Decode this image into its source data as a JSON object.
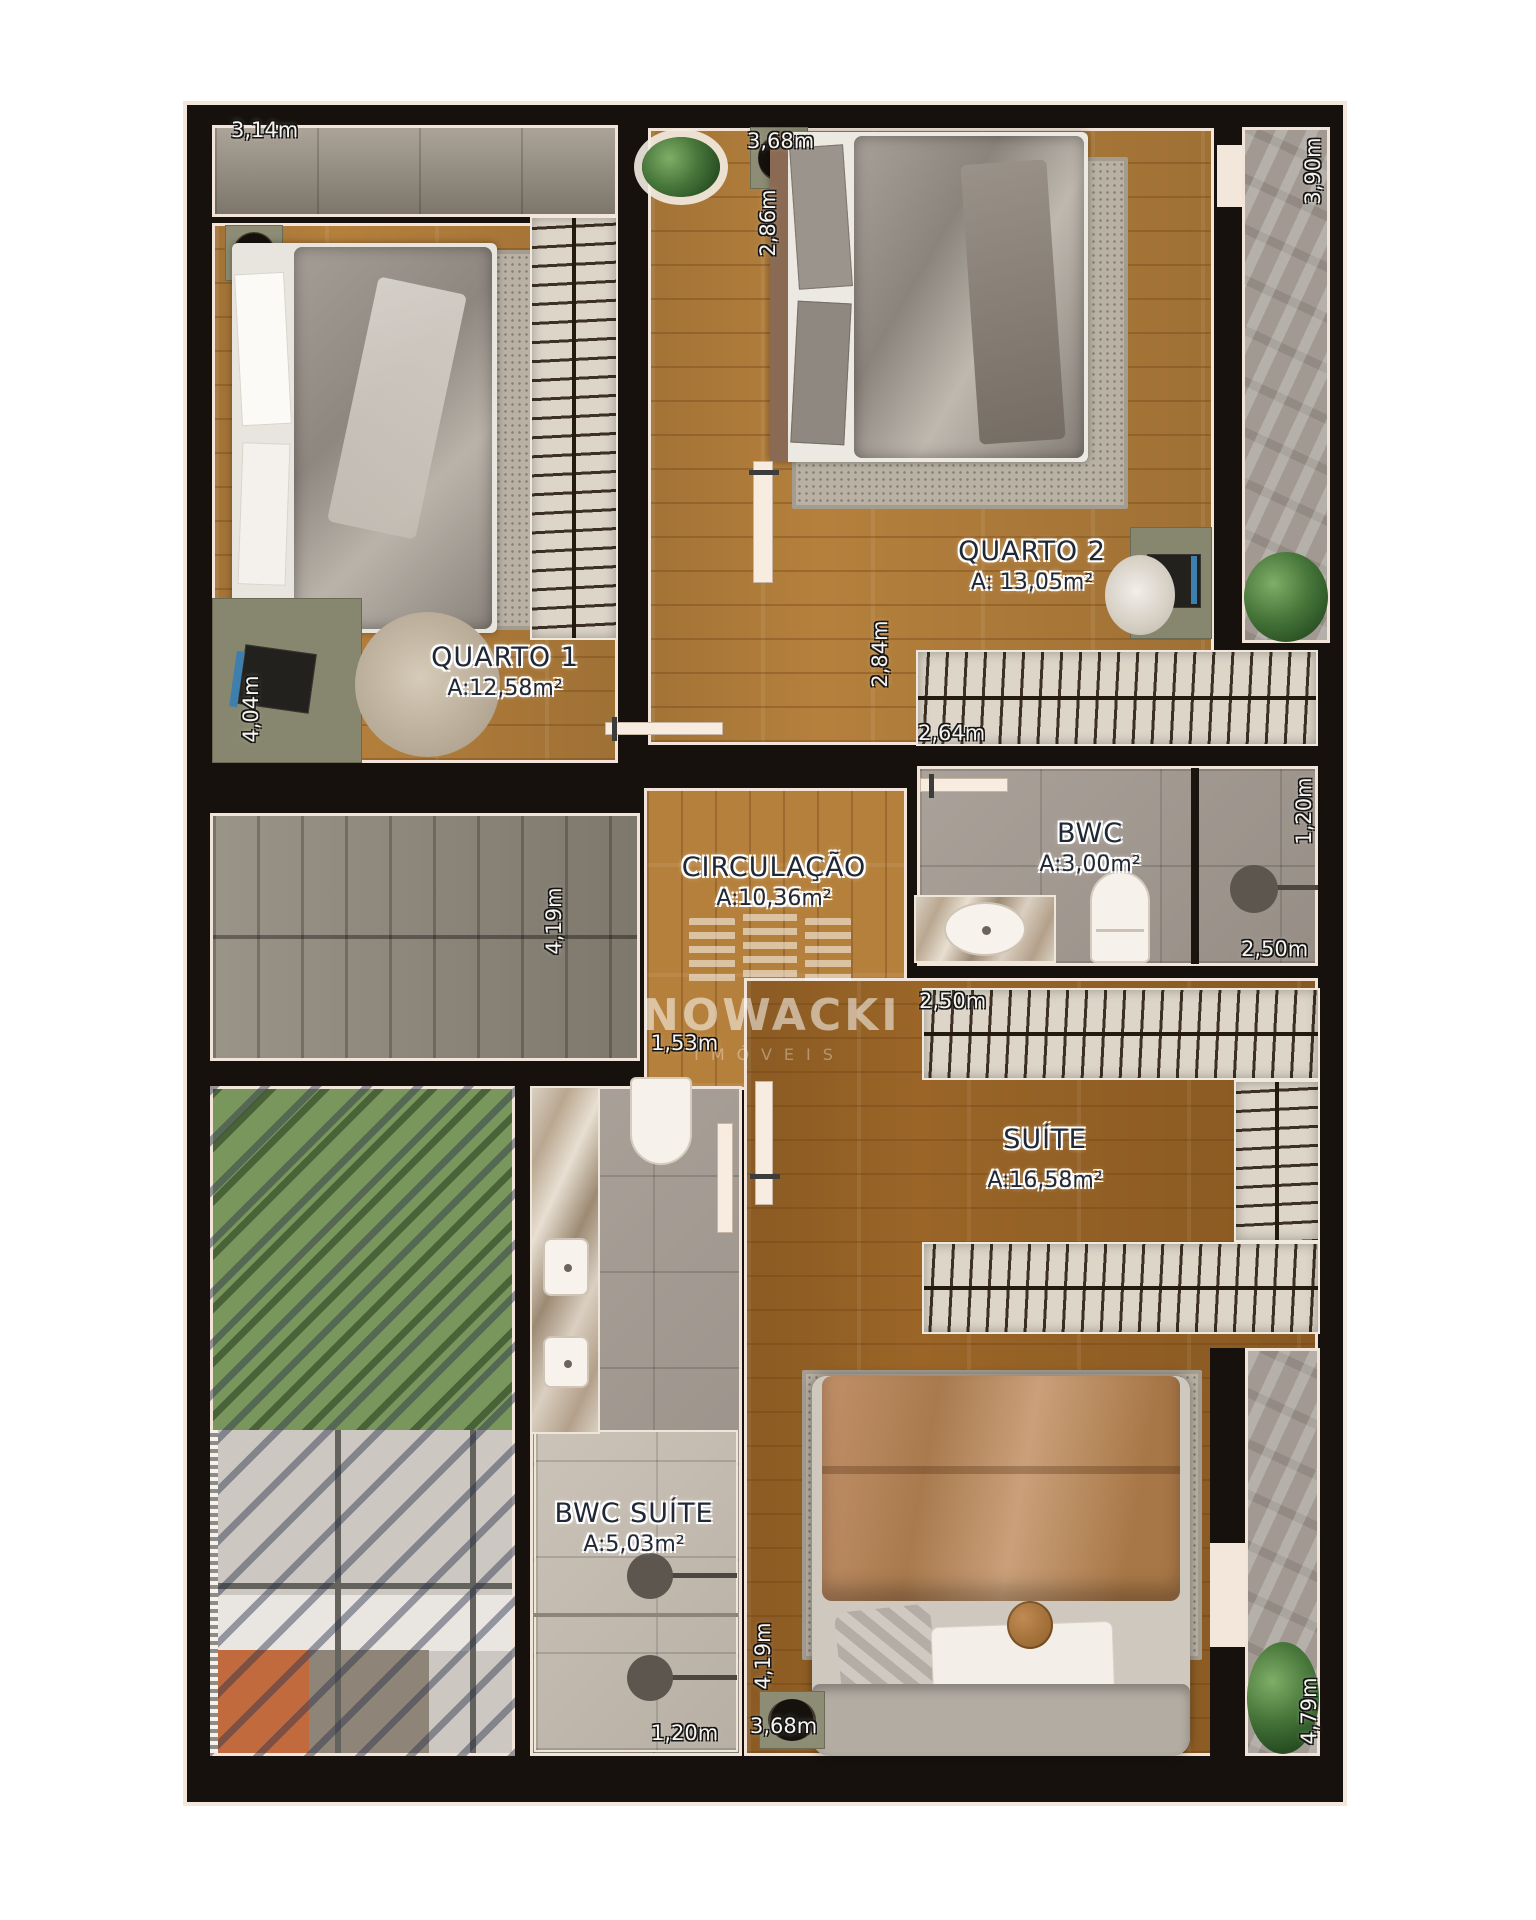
{
  "watermark": {
    "brand": "NOWACKI",
    "subtitle": "IMÓVEIS"
  },
  "rooms": {
    "quarto1": {
      "name": "QUARTO  1",
      "area": "A:12,58m²"
    },
    "quarto2": {
      "name": "QUARTO  2",
      "area": "A: 13,05m²"
    },
    "circulacao": {
      "name": "CIRCULAÇÃO",
      "area": "A:10,36m²"
    },
    "bwc": {
      "name": "BWC",
      "area": "A:3,00m²"
    },
    "suite": {
      "name": "SUÍTE",
      "area": "A:16,58m²"
    },
    "bwc_suite": {
      "name": "BWC SUÍTE",
      "area": "A:5,03m²"
    }
  },
  "dims": {
    "q1_top": "3,14m",
    "q1_left": "4,04m",
    "q2_top": "3,68m",
    "q2_left": "2,86m",
    "balcony_top_right": "3,90m",
    "circ_height": "2,84m",
    "q2_closet": "2,64m",
    "bwc_right": "1,20m",
    "bwc_width": "2,50m",
    "suite_closet": "2,50m",
    "circ_width": "1,53m",
    "bwc_suite_top": "4,19m",
    "suite_left": "4,19m",
    "suite_bottom": "3,68m",
    "bwc_suite_bottom": "1,20m",
    "balcony_bottom_right": "4,79m"
  },
  "palette": {
    "wall": "#16110c",
    "wall_outline": "#f3e6da",
    "wood_floor": "#b5803c",
    "suite_wood": "#9a6527",
    "bath_tile": "#a39a91",
    "stairs_concrete": "#8f887b",
    "garden_green": "#79975c",
    "pergola_navy": "#2a304a",
    "sofa_orange": "#c06a3e"
  }
}
